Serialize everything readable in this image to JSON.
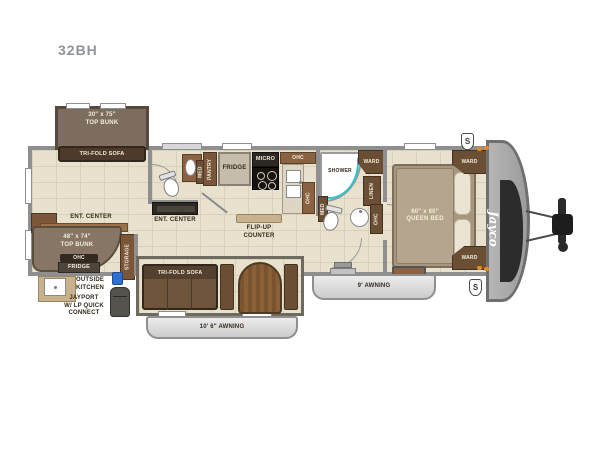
{
  "header": {
    "model": "32BH"
  },
  "exterior": {
    "awning_front": "9' AWNING",
    "awning_rear": "10' 6\" AWNING",
    "brand_logo": "Jayco",
    "stabilizer_badge": "S",
    "outside_kitchen": [
      "OUTSIDE",
      "KITCHEN"
    ],
    "jayport": [
      "JAYPORT",
      "W/ LP QUICK",
      "CONNECT"
    ]
  },
  "bunk_room": {
    "slide_bunk_size": "30\" x 75\"",
    "slide_bunk_name": "TOP BUNK",
    "slide_sofa": "TRI-FOLD SOFA",
    "corner_bunk_size": "48\" x 74\"",
    "corner_bunk_name": "TOP BUNK",
    "corner_ohc": "OHC",
    "corner_fridge": "FRIDGE",
    "ent_center": "ENT. CENTER",
    "storage": "STORAGE"
  },
  "half_bath": {
    "med": "MED"
  },
  "living": {
    "ent_center": "ENT. CENTER",
    "sofa": "TRI-FOLD SOFA"
  },
  "galley": {
    "pantry": "PANTRY",
    "fridge": "FRIDGE",
    "micro": "MICRO",
    "ohc_upper": "OHC",
    "ohc_side": "OHC",
    "flip_up_counter": [
      "FLIP-UP",
      "COUNTER"
    ]
  },
  "bathroom": {
    "shower": "SHOWER",
    "ward": "WARD",
    "linen": "LINEN",
    "med": "MED",
    "ohc": "OHC"
  },
  "bedroom": {
    "bed_size": "60\" x 80\"",
    "bed_name": "QUEEN BED",
    "ward_top": "WARD",
    "ward_bottom": "WARD"
  },
  "colors": {
    "wall": "#8f8f8f",
    "floor": "#e8e1ce",
    "wood": "#7b5639",
    "shower_glass": "#2ec4cd",
    "lp_connector": "#2f6fd0",
    "marker_light": "#e08a2e"
  }
}
